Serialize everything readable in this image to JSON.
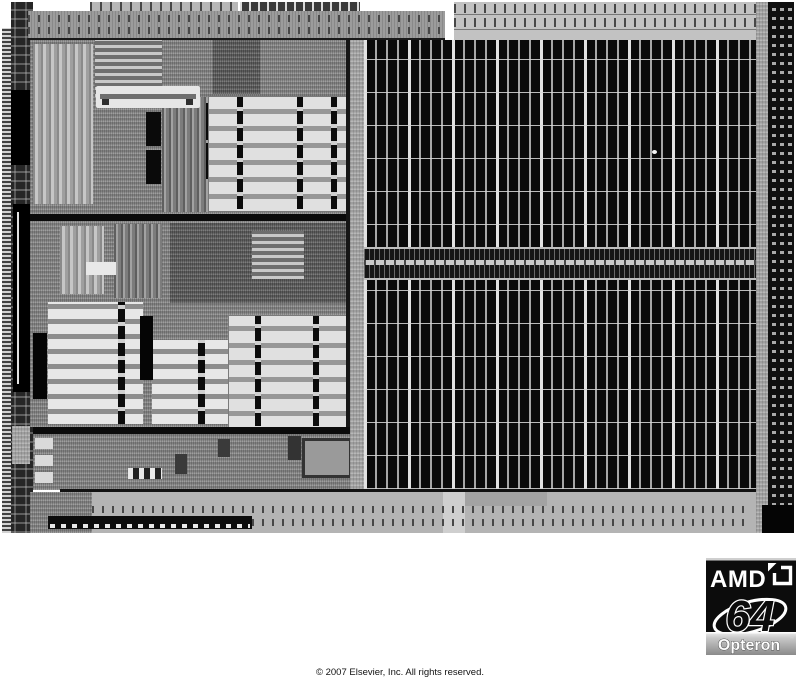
{
  "page": {
    "background": "#ffffff"
  },
  "die": {
    "substrate_gray": "#9a9a9a",
    "cache_black": "#0a0a0a",
    "stripe_light": "#d9d9d9",
    "divider_black": "#0b0b0b"
  },
  "logo": {
    "brand": "AMD",
    "number": "64",
    "product": "Opteron",
    "trademark": "™",
    "colors": {
      "box": "#0c0c0c",
      "text": "#ffffff",
      "band_top": "#efefef",
      "band_bottom": "#8a8a8a"
    }
  },
  "footer": {
    "copyright": "© 2007 Elsevier, Inc. All rights reserved."
  }
}
